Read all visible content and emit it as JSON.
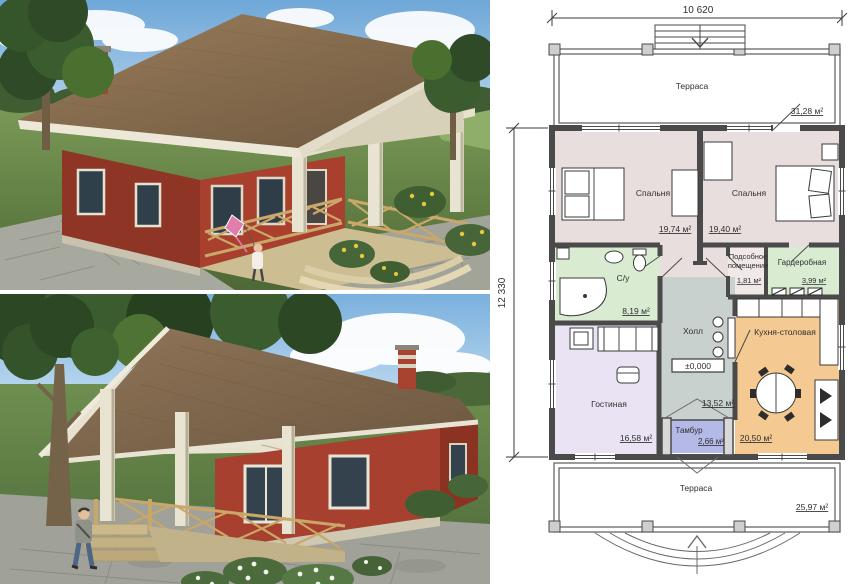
{
  "plan": {
    "width_dim": "10 620",
    "height_dim": "12 330",
    "elevation": "±0,000",
    "terrace_top": {
      "name": "Терраса",
      "area": "31,28 м²"
    },
    "bedroom_left": {
      "name": "Спальня",
      "area": "19,74 м²"
    },
    "bedroom_right": {
      "name": "Спальня",
      "area": "19,40 м²"
    },
    "bathroom": {
      "name": "С/у",
      "area": "8,19 м²"
    },
    "utility": {
      "line1": "Подсобное",
      "line2": "помещение",
      "area": "1,81 м²"
    },
    "wardrobe": {
      "name": "Гардеробная",
      "area": "3,99 м²"
    },
    "hall": {
      "name": "Холл",
      "area": "13,52 м²"
    },
    "kitchen": {
      "name": "Кухня-столовая",
      "area": "20,50 м²"
    },
    "living": {
      "name": "Гостиная",
      "area": "16,58 м²"
    },
    "tambur": {
      "name": "Тамбур",
      "area": "2,66 м²"
    },
    "terrace_bottom": {
      "name": "Терраса",
      "area": "25,97 м²"
    }
  },
  "colors": {
    "bedroom_fill": "#e9dede",
    "bathroom_fill": "#d9ecd2",
    "wardrobe_fill": "#d9ecd2",
    "utility_fill": "#f1e8e8",
    "hall_fill": "#c9d1cf",
    "kitchen_fill": "#f5ca92",
    "living_fill": "#e9e3f4",
    "tambur_fill": "#b4b9e7",
    "roof": "#8a7050",
    "brick": "#a03b2b",
    "column": "#e9e4d2"
  }
}
